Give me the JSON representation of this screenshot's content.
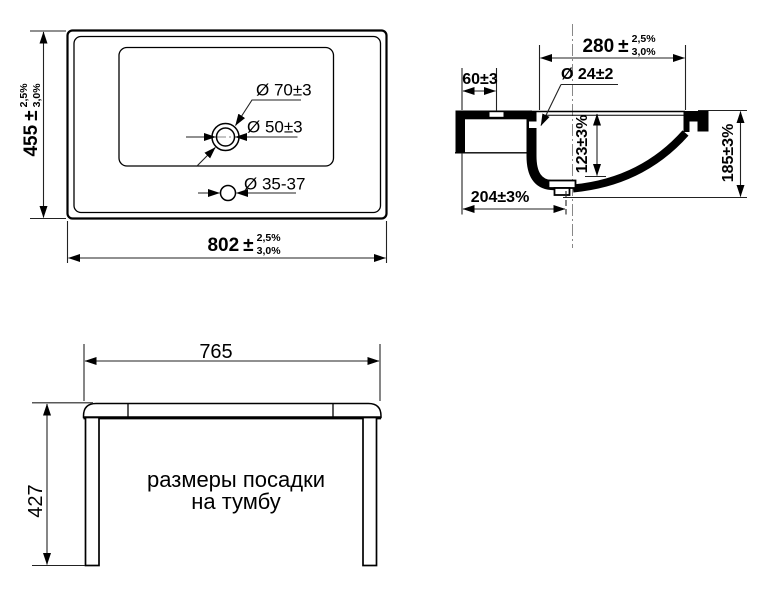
{
  "top_view": {
    "height_dim": {
      "value": "455",
      "pm": "±",
      "tol_upper": "2,5%",
      "tol_lower": "3,0%"
    },
    "width_dim": {
      "value": "802",
      "pm": "±",
      "tol_upper": "2,5%",
      "tol_lower": "3,0%"
    },
    "drain_outer_label": "Ø 70±3",
    "drain_inner_label": "Ø 50±3",
    "faucet_hole_label": "Ø 35-37"
  },
  "section_view": {
    "rim_width_dim": {
      "value": "280",
      "pm": "±",
      "tol_upper": "2,5%",
      "tol_lower": "3,0%"
    },
    "front_ledge_dim": "60±3",
    "overflow_hole_label": "Ø 24±2",
    "bowl_depth_dim": "123±3%",
    "front_overhang_dim": "204±3%",
    "total_height_dim": "185±3%"
  },
  "mounting_view": {
    "width_dim": "765",
    "height_dim": "427",
    "caption_line1": "размеры посадки",
    "caption_line2": "на тумбу"
  },
  "colors": {
    "background": "#ffffff",
    "object_line": "#000000",
    "dimension_line": "#222222",
    "centerline": "#888888"
  }
}
